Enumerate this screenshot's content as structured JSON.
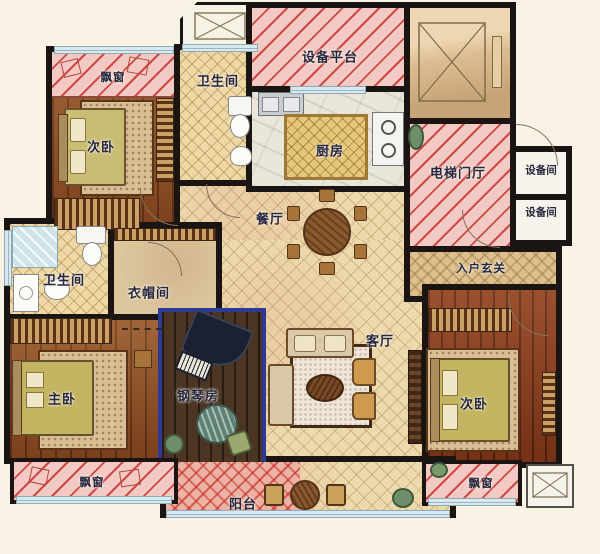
{
  "plan": {
    "labels": {
      "bay_top_left": "飘窗",
      "bedroom_a": "次卧",
      "bath_top": "卫生间",
      "equip_platform": "设备平台",
      "kitchen": "厨房",
      "elevator_hall": "电梯门厅",
      "equip_room_1": "设备间",
      "equip_room_2": "设备间",
      "dining": "餐厅",
      "foyer": "入户玄关",
      "bath_left": "卫生间",
      "cloakroom": "衣帽间",
      "master": "主卧",
      "piano_room": "钢琴房",
      "living": "客厅",
      "bedroom_b": "次卧",
      "bay_bottom_left": "飘窗",
      "balcony": "阳台",
      "bay_bottom_right": "飘窗"
    },
    "colors": {
      "background": "#f8f3e4",
      "wall": "#1a1512",
      "bay_pink": "#f3cac3",
      "hatch_red": "#c33a30",
      "tile_floor": "#ecd9ac",
      "wood_floor": "#8d4c24",
      "piano_room_border": "#2b3a96",
      "elevator_cab": "#dcbd92",
      "label_text": "#262640"
    }
  }
}
